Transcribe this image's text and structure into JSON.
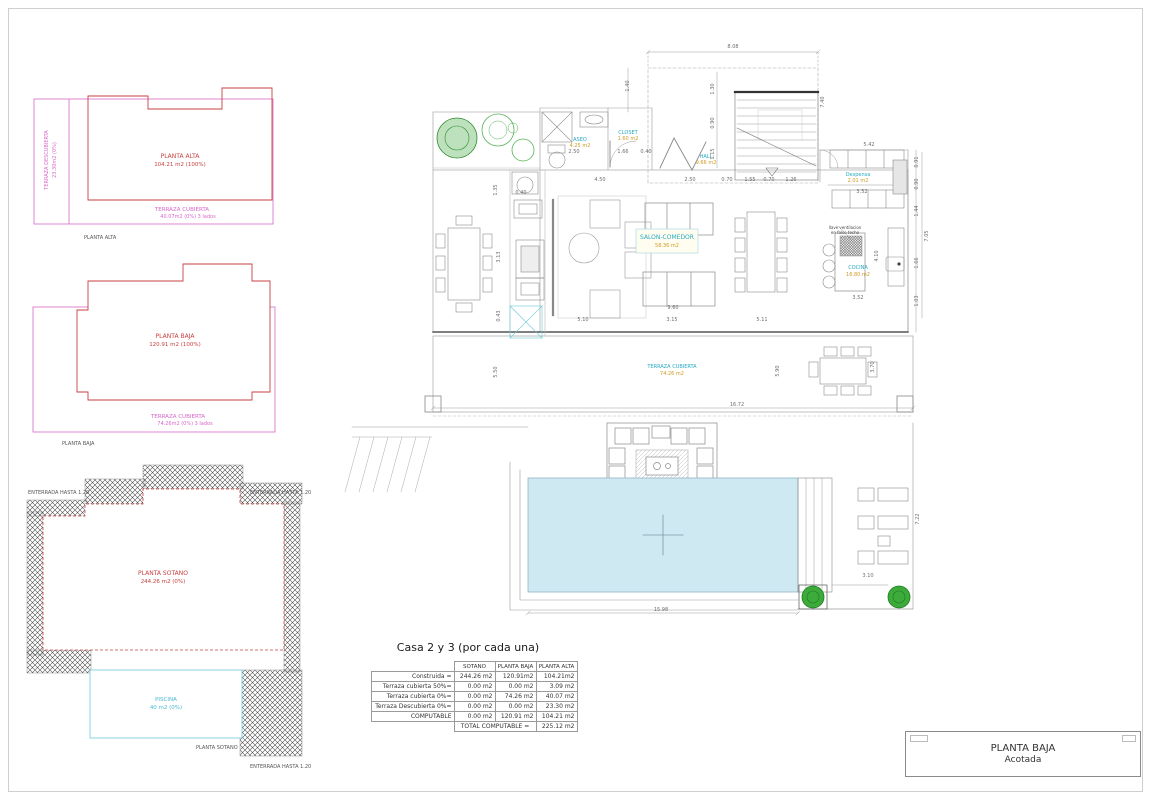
{
  "left_diagrams": {
    "planta_alta": {
      "label": "PLANTA ALTA",
      "area": "104.21 m2 (100%)",
      "terraza_descubierta_label": "TERRAZA DESCUBIERTA",
      "terraza_descubierta_area": "23.30m2 (0%)",
      "terraza_cubierta_label": "TERRAZA CUBIERTA",
      "terraza_cubierta_area": "40.07m2 (0%) 3 lados",
      "caption": "PLANTA ALTA"
    },
    "planta_baja": {
      "label": "PLANTA BAJA",
      "area": "120.91  m2 (100%)",
      "terraza_cubierta_label": "TERRAZA CUBIERTA",
      "terraza_cubierta_area": "74.26m2 (0%) 3 lados",
      "caption": "PLANTA BAJA"
    },
    "planta_sotano": {
      "label": "PLANTA SOTANO",
      "area": "244.26  m2 (0%)",
      "piscina_label": "PISCINA",
      "piscina_area": "40  m2 (0%)",
      "caption": "PLANTA SOTANO",
      "enterrada_label_1": "ENTERRADA HASTA  1.20",
      "enterrada_label_2": "ENTERRADA HASTA  1.20",
      "enterrada_label_3": "ENTERRADA HASTA  1.20"
    }
  },
  "plan": {
    "rooms": {
      "aseo": {
        "name": "ASEO",
        "area": "4.25 m2"
      },
      "closet": {
        "name": "CLOSET",
        "area": "1.60 m2"
      },
      "hall": {
        "name": "HALL",
        "area": "9.66 m2"
      },
      "salon": {
        "name": "SALON-COMEDOR",
        "area": "58.36 m2"
      },
      "despensa": {
        "name": "Despensa",
        "area": "2.01 m2"
      },
      "cocina": {
        "name": "COCINA",
        "area": "16.80 m2"
      },
      "terraza": {
        "name": "TERRAZA CUBIERTA",
        "area": "74.26 m2"
      }
    },
    "note_line1": "llave ventilacion",
    "note_line2": "en falso techo",
    "dims": [
      "8.08",
      "1.40",
      "1.30",
      "0.90",
      "1.15",
      "7.40",
      "2.50",
      "1.66",
      "0.40",
      "4.50",
      "2.50",
      "0.70",
      "1.55",
      "0.70",
      "1.26",
      "5.42",
      "3.52",
      "0.91",
      "0.90",
      "1.44",
      "7.05",
      "1.66",
      "1.03",
      "4.10",
      "3.52",
      "9.60",
      "5.10",
      "3.15",
      "5.11",
      "3.13",
      "5.50",
      "5.90",
      "3.70",
      "16.72",
      "15.98",
      "3.10",
      "7.22",
      "1.35",
      "0.40",
      "0.43"
    ]
  },
  "table": {
    "title": "Casa 2 y 3 (por cada una)",
    "headers": {
      "c0": "SOTANO",
      "c1": "PLANTA BAJA",
      "c2": "PLANTA ALTA"
    },
    "rows": [
      {
        "label": "Construida =",
        "v0": "244.26 m2",
        "v1": "120.91m2",
        "v2": "104.21m2"
      },
      {
        "label": "Terraza cubierta 50%=",
        "v0": "0.00 m2",
        "v1": "0.00 m2",
        "v2": "3.09 m2"
      },
      {
        "label": "Terraza cubierta 0%=",
        "v0": "0.00 m2",
        "v1": "74.26 m2",
        "v2": "40.07 m2"
      },
      {
        "label": "Terraza Descubierta 0%=",
        "v0": "0.00 m2",
        "v1": "0.00 m2",
        "v2": "23.30 m2"
      },
      {
        "label": "COMPUTABLE",
        "v0": "0.00 m2",
        "v1": "120.91 m2",
        "v2": "104.21 m2"
      }
    ],
    "total_label": "TOTAL COMPUTABLE =",
    "total_value": "225.12 m2"
  },
  "title_block": {
    "line1": "PLANTA BAJA",
    "line2": "Acotada"
  }
}
